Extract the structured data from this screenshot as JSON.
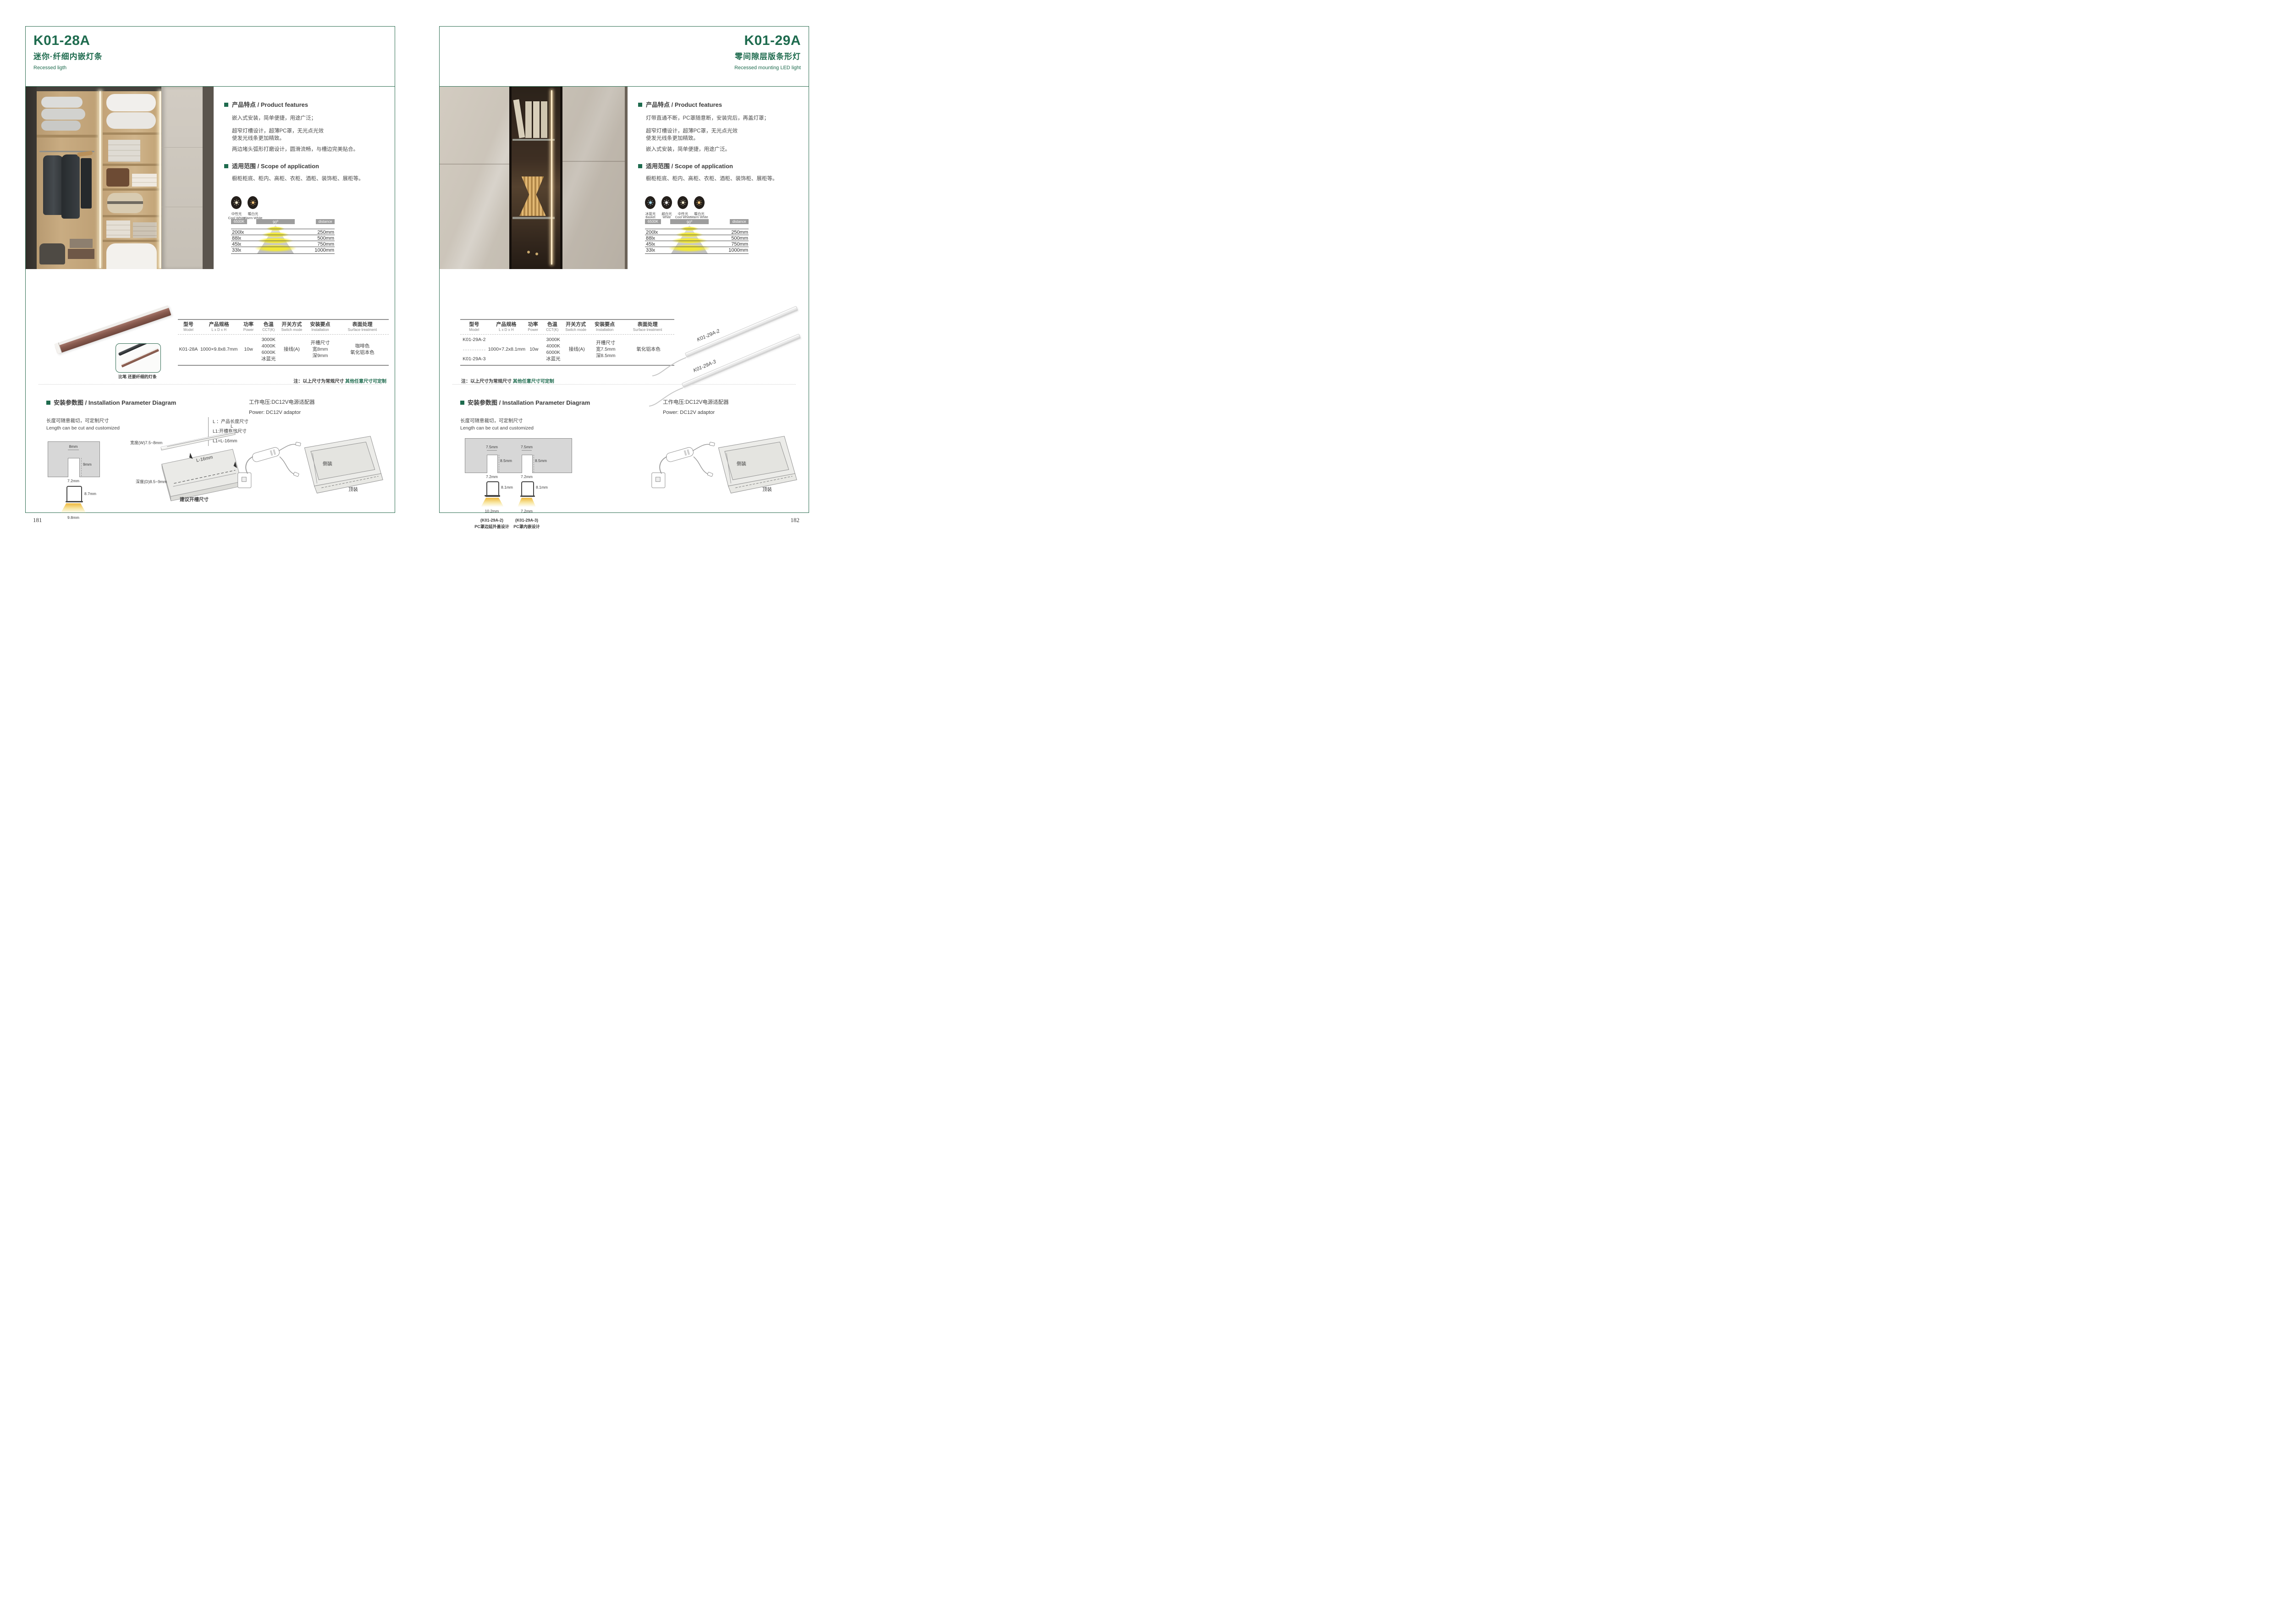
{
  "colors": {
    "brand_green": "#1E6B4E",
    "border_green": "#2E6E52",
    "text_dark": "#3C3C3C",
    "gray_label_box": "#9D9D9D",
    "cone_yellow": "#F0E73A",
    "profile_brown": "#8A5C50"
  },
  "page_left": {
    "page_number": "181",
    "model": "K01-28A",
    "subtitle_cn": "迷你·纤细内嵌灯条",
    "subtitle_en": "Recessed ligth",
    "features_heading": "产品特点 / Product features",
    "feature_lines": [
      "嵌入式安装，简单便捷，用途广泛；",
      "超窄灯槽设计，超薄PC罩，无光点光效",
      "使发光线条更加精致。",
      "两边堵头弧形打磨设计，圆滑流畅，与槽边完美贴合。"
    ],
    "scope_heading": "适用范围 / Scope of application",
    "scope_body": "橱柜柜底、柜内、高柜、衣柜、酒柜、装饰柜、展柜等。",
    "light_modes": [
      {
        "cn": "中性光",
        "en": "Cool White",
        "color": "#F6ECCF"
      },
      {
        "cn": "暖白光",
        "en": "Warm White",
        "color": "#EFC178"
      }
    ],
    "beam": {
      "cct": "6500K",
      "angle": "90",
      "angle_sup": "0",
      "distance": "distance",
      "rows": [
        {
          "lux": "200lx",
          "mm": "250mm"
        },
        {
          "lux": "88lx",
          "mm": "500mm"
        },
        {
          "lux": "45lx",
          "mm": "750mm"
        },
        {
          "lux": "33lx",
          "mm": "1000mm"
        }
      ]
    },
    "product_caption": "比笔 还要纤细的灯条",
    "spec": {
      "headers": [
        {
          "cn": "型号",
          "en": "Model"
        },
        {
          "cn": "产品规格",
          "en": "L x D x H"
        },
        {
          "cn": "功率",
          "en": "Power"
        },
        {
          "cn": "色温",
          "en": "CCT(K)"
        },
        {
          "cn": "开关方式",
          "en": "Switch mode"
        },
        {
          "cn": "安装要点",
          "en": "Installation"
        },
        {
          "cn": "表面处理",
          "en": "Surface treatment"
        }
      ],
      "model": "K01-28A",
      "size": "1000×9.8x8.7mm",
      "power": "10w",
      "cct": [
        "3000K",
        "4000K",
        "6000K",
        "冰蓝光"
      ],
      "switch_mode": "接线(A)",
      "installation": [
        "开槽尺寸",
        "宽8mm",
        "深9mm"
      ],
      "surface": [
        "咖啡色",
        "氧化铝本色"
      ]
    },
    "note_prefix": "注：以上尺寸为常规尺寸 ",
    "note_highlight": "其他任意尺寸可定制",
    "install": {
      "heading": "安装参数图 / Installation Parameter Diagram",
      "cut_cn": "长度可随意裁切，可定制尺寸",
      "cut_en": "Length can be cut and customized",
      "legend": [
        "L ：产品长度尺寸",
        "L1:开槽有效尺寸",
        "L1=L-16mm"
      ],
      "dim_top": "8mm",
      "dim_depth": "9mm",
      "dim_slot": "7.2mm",
      "dim_height": "8.7mm",
      "dim_bottom": "9.8mm",
      "board_l": "L",
      "board_w": "宽度(W)7.5~8mm",
      "board_l16": "L-16mm",
      "board_d": "深度(D)8.5~9mm",
      "board_caption": "建议开槽尺寸"
    },
    "power": {
      "cn": "工作电压:DC12V电源适配器",
      "en": "Power: DC12V adaptor",
      "side": "侧装",
      "top": "顶装"
    }
  },
  "page_right": {
    "page_number": "182",
    "model": "K01-29A",
    "subtitle_cn": "零间隙层版条形灯",
    "subtitle_en": "Recessed mounting LED light",
    "features_heading": "产品特点 / Product features",
    "feature_lines": [
      "灯带直通不断，PC罩随意断，安装完后，再盖灯罩；",
      "超窄灯槽设计，超薄PC罩，无光点光效",
      "使发光线条更加精致。",
      "嵌入式安装，简单便捷，用途广泛。"
    ],
    "scope_heading": "适用范围 / Scope of application",
    "scope_body": "橱柜柜底、柜内、高柜、衣柜、酒柜、装饰柜、展柜等。",
    "light_modes": [
      {
        "cn": "冰蓝光",
        "en": "Basket",
        "color": "#A9D9EE"
      },
      {
        "cn": "超白光",
        "en": "White",
        "color": "#FFFFFF"
      },
      {
        "cn": "中性光",
        "en": "Cool White",
        "color": "#F6ECCF"
      },
      {
        "cn": "暖白光",
        "en": "Warm White",
        "color": "#EFC178"
      }
    ],
    "beam": {
      "cct": "6500K",
      "angle": "90",
      "angle_sup": "0",
      "distance": "distance",
      "rows": [
        {
          "lux": "200lx",
          "mm": "250mm"
        },
        {
          "lux": "88lx",
          "mm": "500mm"
        },
        {
          "lux": "45lx",
          "mm": "750mm"
        },
        {
          "lux": "33lx",
          "mm": "1000mm"
        }
      ]
    },
    "strip_labels": [
      "K01-29A-2",
      "K01-29A-3"
    ],
    "spec": {
      "headers": [
        {
          "cn": "型号",
          "en": "Model"
        },
        {
          "cn": "产品规格",
          "en": "L x D x H"
        },
        {
          "cn": "功率",
          "en": "Power"
        },
        {
          "cn": "色温",
          "en": "CCT(K)"
        },
        {
          "cn": "开关方式",
          "en": "Switch mode"
        },
        {
          "cn": "安装要点",
          "en": "Installation"
        },
        {
          "cn": "表面处理",
          "en": "Surface treatment"
        }
      ],
      "models": [
        "K01-29A-2",
        "K01-29A-3"
      ],
      "size": "1000×7.2x8.1mm",
      "power": "10w",
      "cct": [
        "3000K",
        "4000K",
        "6000K",
        "冰蓝光"
      ],
      "switch_mode": "接线(A)",
      "installation": [
        "开槽尺寸",
        "宽7.5mm",
        "深8.5mm"
      ],
      "surface": [
        "氧化铝本色"
      ]
    },
    "note_prefix": "注：以上尺寸为常规尺寸 ",
    "note_highlight": "其他任意尺寸可定制",
    "install": {
      "heading": "安装参数图 / Installation Parameter Diagram",
      "cut_cn": "长度可随意裁切，可定制尺寸",
      "cut_en": "Length can be cut and customized",
      "sections": [
        {
          "top": "7.5mm",
          "depth": "8.5mm",
          "slot": "7.2mm",
          "height": "8.1mm",
          "bottom": "10.2mm",
          "model": "(K01-29A-2)",
          "caption": "PC罩边延外盖设计"
        },
        {
          "top": "7.5mm",
          "depth": "8.5mm",
          "slot": "7.2mm",
          "height": "8.1mm",
          "bottom": "7.2mm",
          "model": "(K01-29A-3)",
          "caption": "PC罩内嵌设计"
        }
      ]
    },
    "power": {
      "cn": "工作电压:DC12V电源适配器",
      "en": "Power: DC12V adaptor",
      "side": "侧装",
      "top": "顶装"
    }
  }
}
